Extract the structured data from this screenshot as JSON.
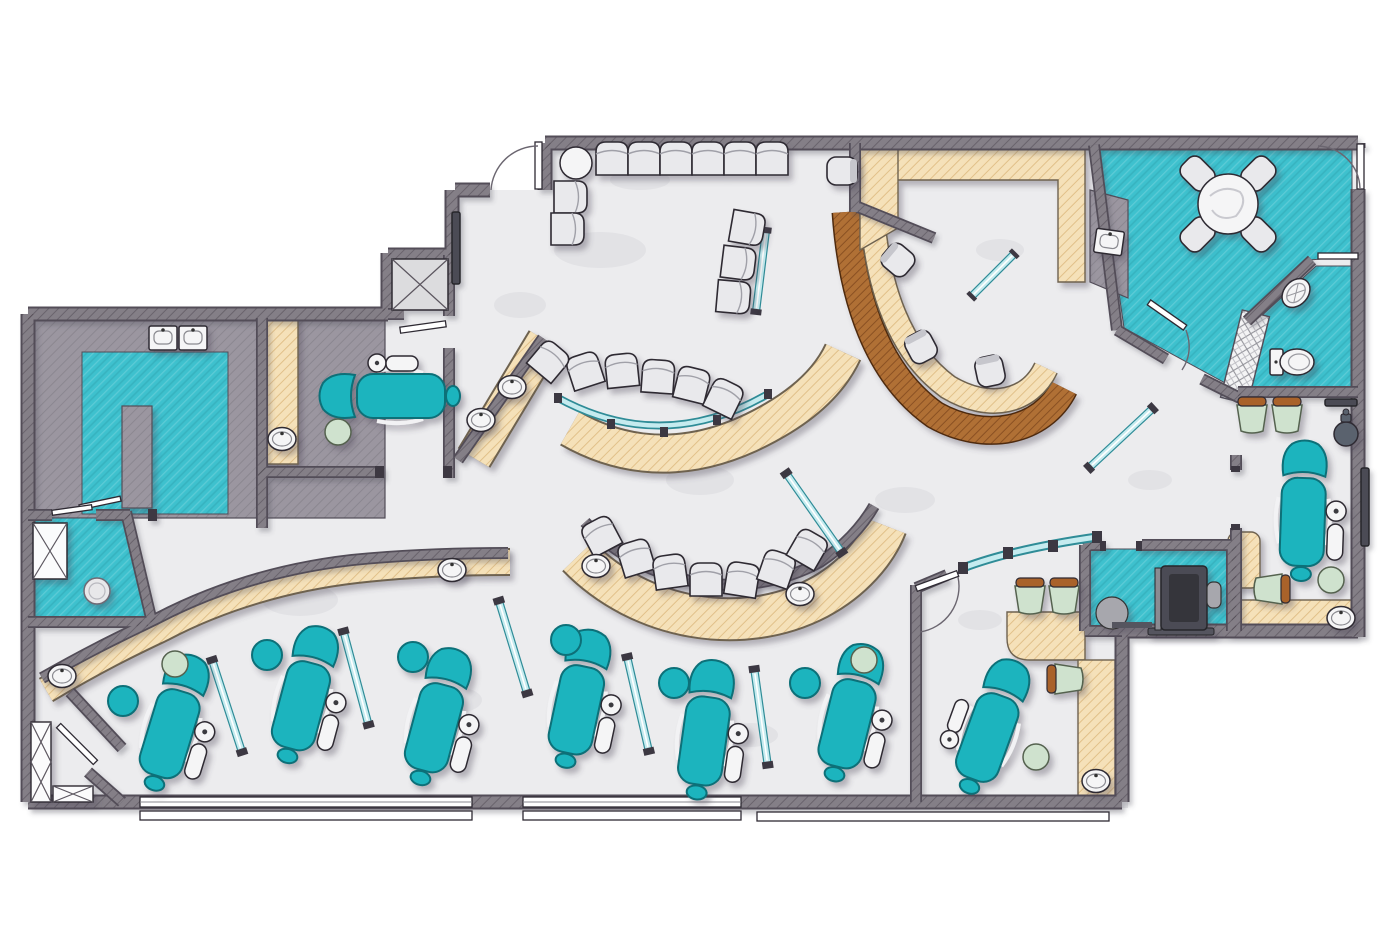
{
  "title": "Dental Clinic Floor Plan",
  "palette": {
    "wall": "#847f87",
    "wall_dark": "#524d58",
    "floor": "#ececee",
    "teal_floor": "#3ec1ce",
    "counter_tan": "#f5e1b9",
    "wood": "#b06f36",
    "counter_gray": "#9b96a0",
    "chair_teal": "#1cb4be",
    "chair_teal_dark": "#0a6f78",
    "furn_white": "#f5f5f6",
    "stool_green": "#cfe2ce",
    "brown_cap": "#a9622b",
    "glass": "#c5ebef",
    "glass_frame": "#2f8c97",
    "outline": "#2e2a33",
    "equip_dark": "#4c4c54"
  },
  "rooms": [
    {
      "name": "waiting-area",
      "floor": "light"
    },
    {
      "name": "reception-desk",
      "floor": "light"
    },
    {
      "name": "business-office",
      "floor": "light"
    },
    {
      "name": "break-room",
      "floor": "teal"
    },
    {
      "name": "restroom",
      "floor": "teal"
    },
    {
      "name": "consultation-room",
      "floor": "light"
    },
    {
      "name": "imaging-xray-room",
      "floor": "teal"
    },
    {
      "name": "private-operatory-right",
      "floor": "light"
    },
    {
      "name": "private-operatory-left",
      "floor": "light"
    },
    {
      "name": "open-treatment-bay",
      "floor": "light"
    },
    {
      "name": "orthodontic-bay",
      "floor": "light"
    },
    {
      "name": "sterilization-lab",
      "floor": "teal"
    },
    {
      "name": "utility-room",
      "floor": "teal"
    },
    {
      "name": "storage-closet",
      "floor": "light"
    }
  ],
  "inventory": {
    "dental_chairs": 9,
    "dental_delivery_units": 9,
    "operator_stools_teal": 6,
    "assistant_stools_green": 5,
    "utility_stool_white": 1,
    "waiting_chairs": 11,
    "waiting_coffee_tables": 1,
    "ortho_bay_chairs": 12,
    "office_task_chairs": 4,
    "side_chairs_green": 6,
    "break_table_chairs": 4,
    "break_tables": 1,
    "sinks_round": 9,
    "sinks_square": 3,
    "bathroom_sinks": 1,
    "toilets": 1,
    "panoramic_xray_machines": 1,
    "glass_partitions": 11,
    "coat_stands": 1,
    "equipment_shafts": 2,
    "storage_cabinets": 3
  }
}
